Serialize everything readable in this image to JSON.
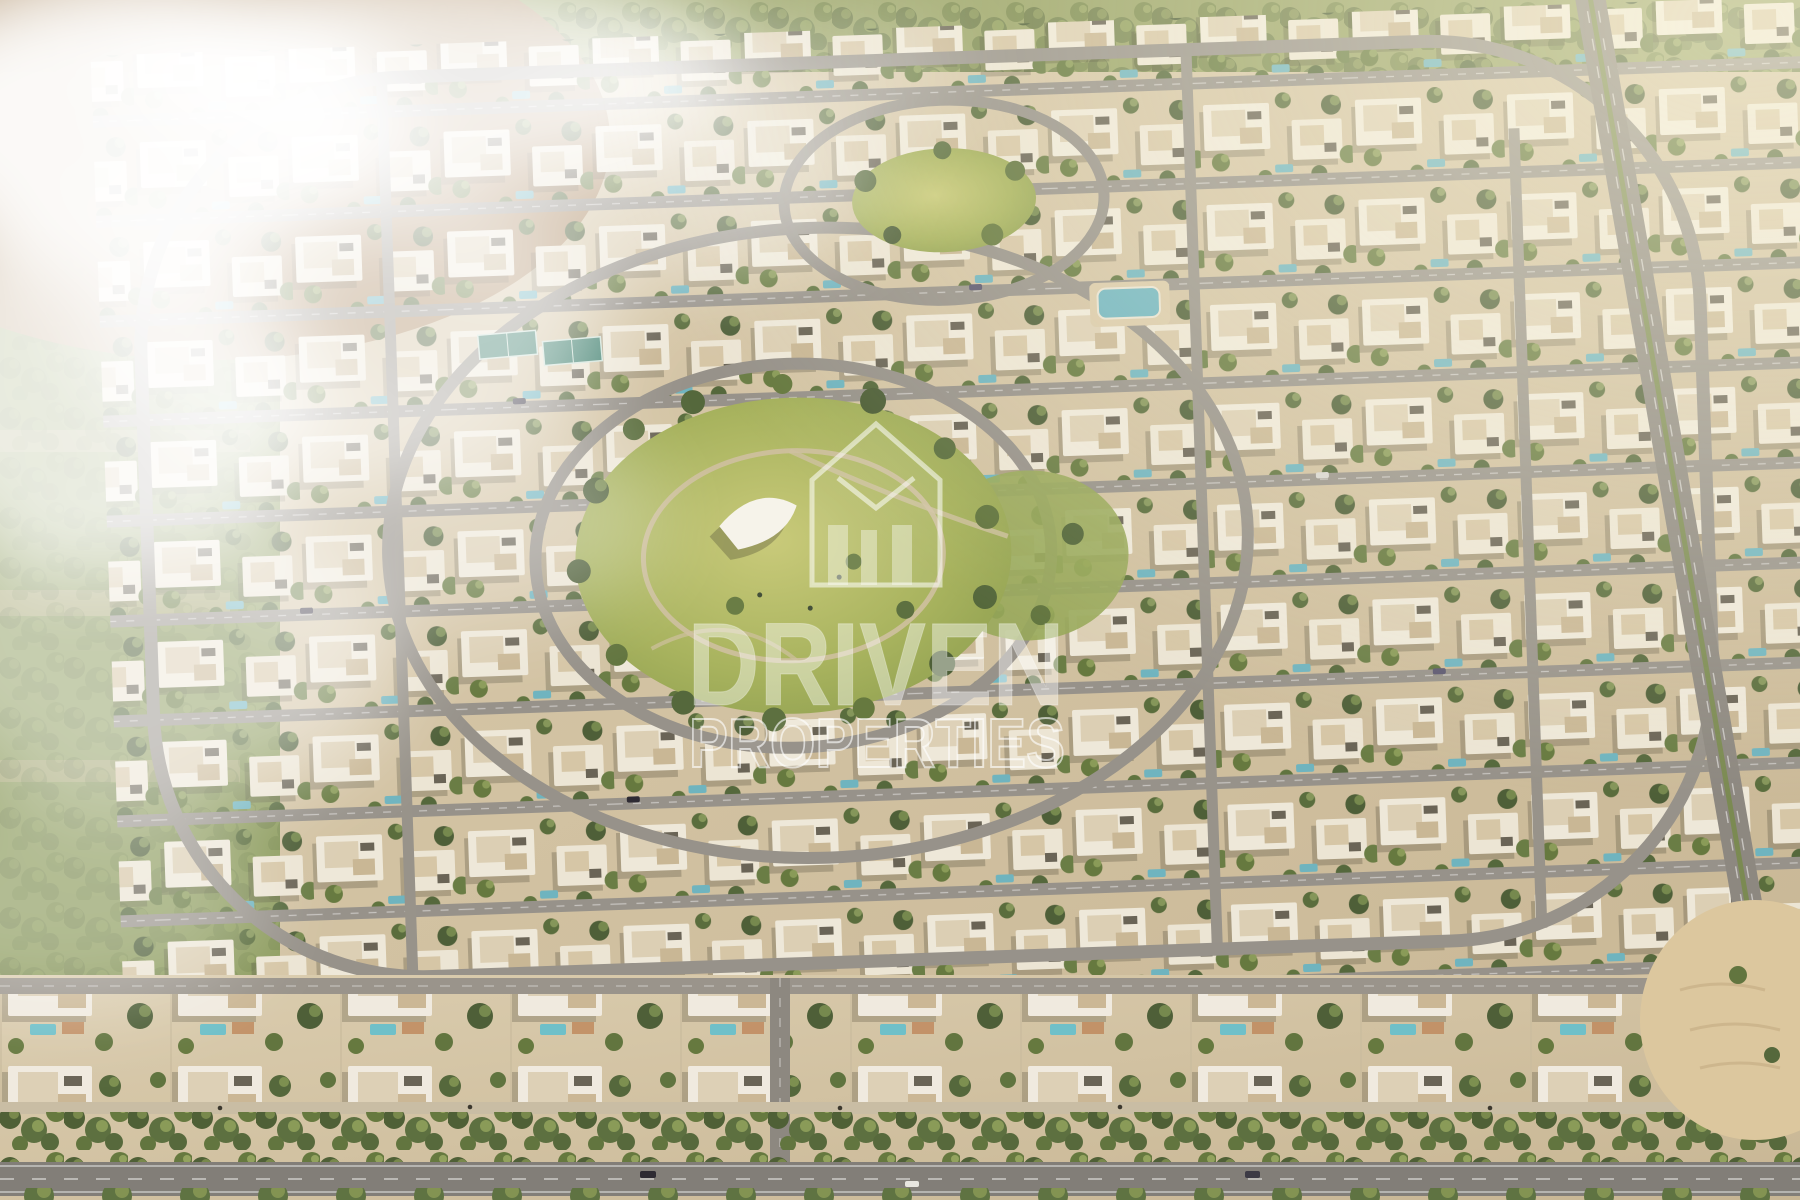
{
  "scene": {
    "type": "aerial-3d-render",
    "subject": "Master-planned villa community seen from the air: rows of white modern villas, concentric loop roads, a central park with shade canopy, a pocket park, tennis courts, a tree-lined boulevard at the bottom, and white fog over desert and green fields at the top-left",
    "palette": {
      "sand": "#d3c4a4",
      "villa_white": "#eee8d9",
      "villa_roof_beige": "#d6c6a6",
      "tree_green": "#5c6e3f",
      "lawn_green": "#a8b35e",
      "road_gray": "#97928a",
      "boulevard_gray": "#827e78",
      "pool_blue": "#6fb4bf",
      "fog_white": "#ffffff",
      "desert_tan": "#ad8c66",
      "field_green": "#8d9c5e"
    }
  },
  "watermark": {
    "logo": "driven-properties-house-logo-icon",
    "brand": "DRIVEN",
    "brand_sub": "PROPERTIES",
    "text_color": "#ffffff"
  }
}
